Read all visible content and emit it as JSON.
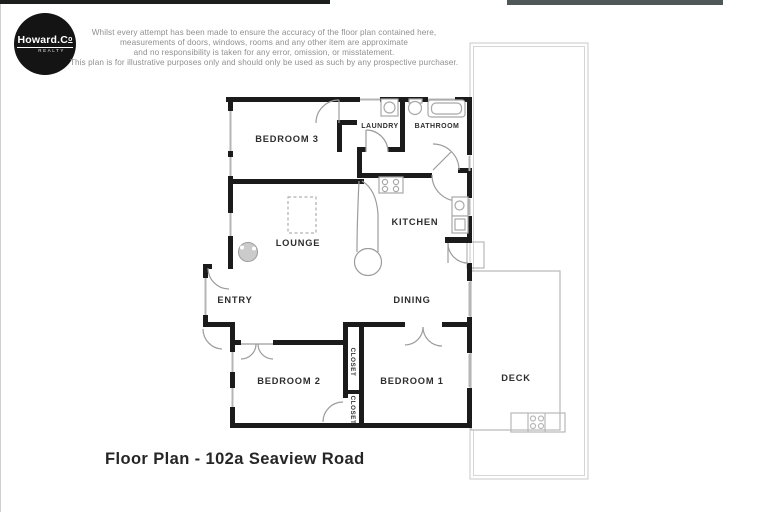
{
  "logo": {
    "brand_main": "Howard.C",
    "brand_sup": "o",
    "tagline": "REALTY"
  },
  "disclaimer": {
    "lines": [
      "Whilst every attempt has been made to ensure the accuracy of the floor plan contained here,",
      "measurements of doors, windows, rooms and any other item are approximate",
      "and no responsibility is taken for any error, omission, or misstatement.",
      "This plan is for illustrative purposes only and should only be used as such by any prospective purchaser."
    ]
  },
  "floor_plan": {
    "labels": {
      "bedroom3": "BEDROOM 3",
      "laundry": "LAUNDRY",
      "bathroom": "BATHROOM",
      "kitchen": "KITCHEN",
      "lounge": "LOUNGE",
      "entry": "ENTRY",
      "dining": "DINING",
      "bedroom2": "BEDROOM 2",
      "bedroom1": "BEDROOM 1",
      "closet_upper": "CLOSET",
      "closet_lower": "CLOSET",
      "deck": "DECK"
    },
    "colors": {
      "wall": "#1b1b1b",
      "window_line": "#b5b5b5",
      "door_arc": "#9c9c9c",
      "label_text": "#2e2e2e",
      "boundary_line": "#c9c9c9",
      "logo_background": "#141414"
    }
  },
  "caption": "Floor Plan - 102a Seaview Road"
}
